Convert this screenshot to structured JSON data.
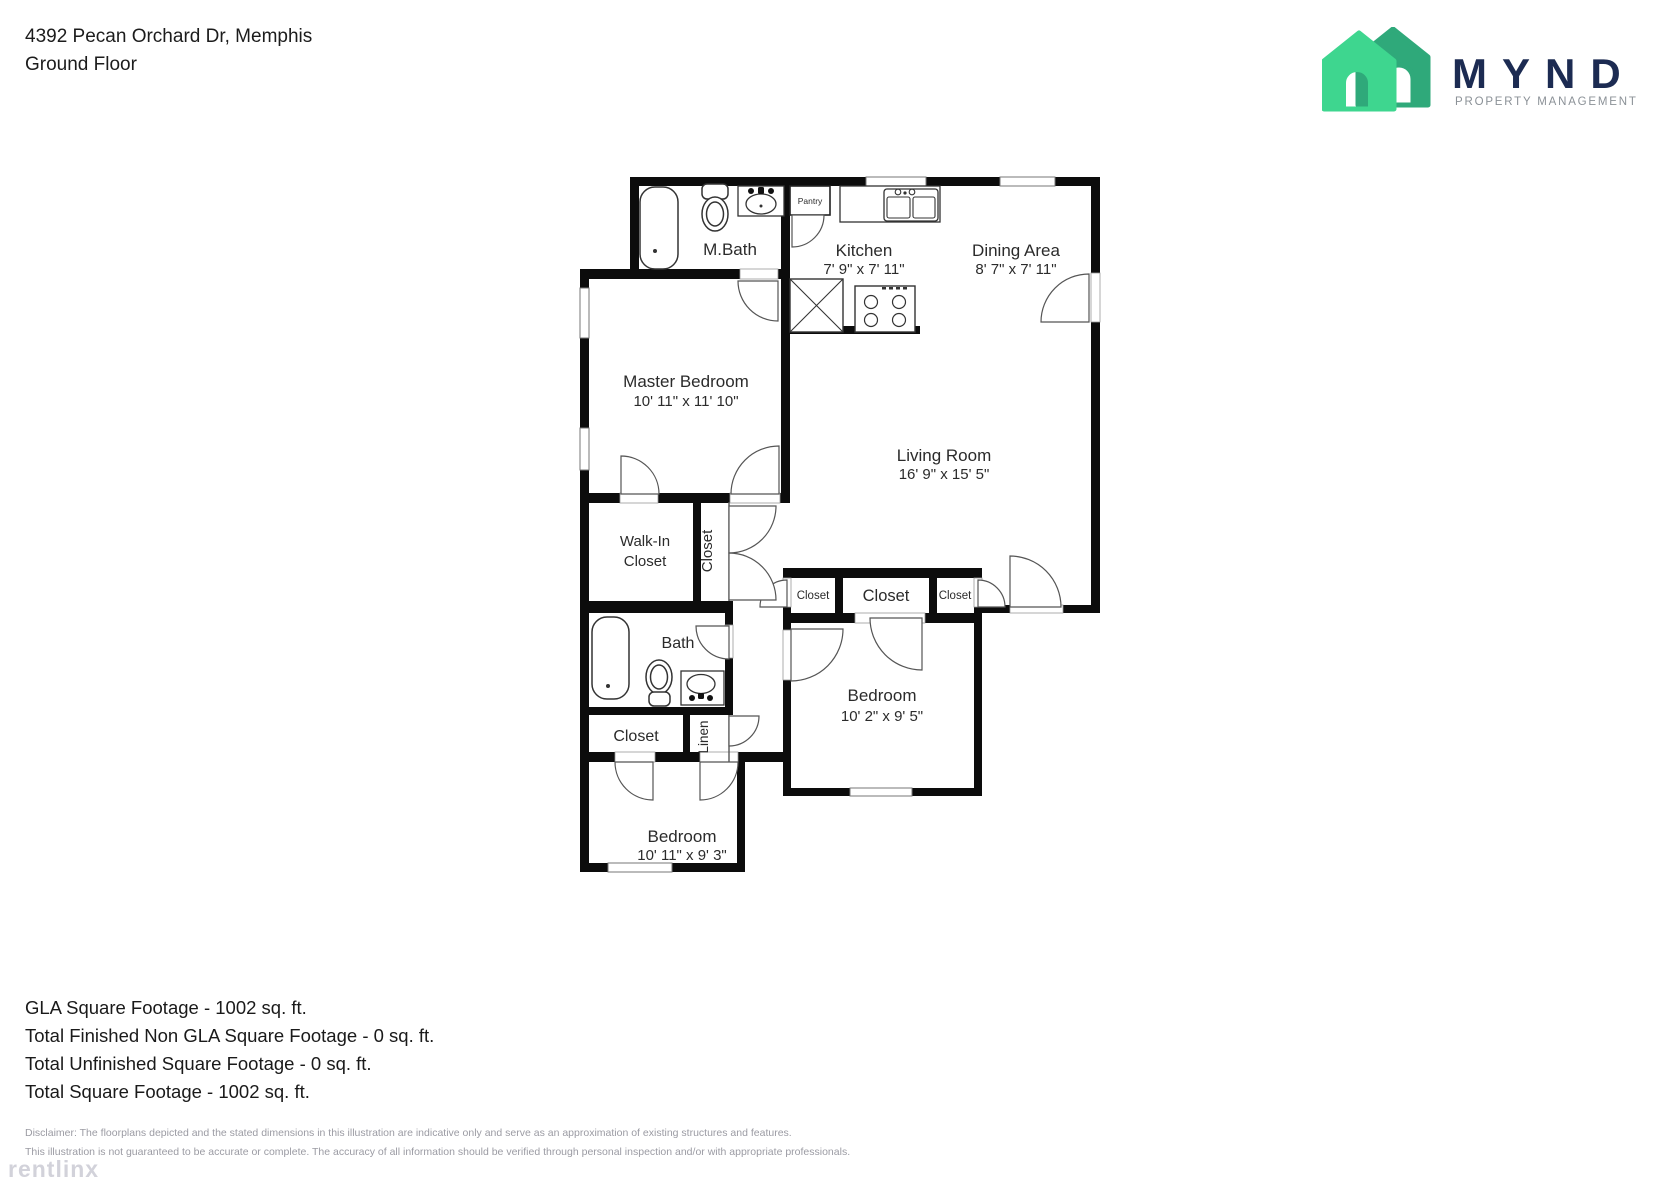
{
  "header": {
    "address": "4392 Pecan Orchard Dr, Memphis",
    "floor": "Ground Floor"
  },
  "logo": {
    "brand": "MYND",
    "tagline": "PROPERTY MANAGEMENT"
  },
  "colors": {
    "logo_green_front": "#3ED68F",
    "logo_green_back": "#2FA97A",
    "logo_navy": "#1C2B52",
    "tagline_gray": "#8B9197",
    "wall_black": "#0C0C0C"
  },
  "plan": {
    "labels": {
      "mbath": "M.Bath",
      "pantry": "Pantry",
      "kitchen_name": "Kitchen",
      "kitchen_dims": "7' 9\" x 7' 11\"",
      "dining_name": "Dining Area",
      "dining_dims": "8' 7\" x 7' 11\"",
      "master_name": "Master Bedroom",
      "master_dims": "10' 11\" x 11' 10\"",
      "living_name": "Living Room",
      "living_dims": "16' 9\" x 15' 5\"",
      "walkin_1": "Walk-In",
      "walkin_2": "Closet",
      "closet_vertical": "Closet",
      "bath": "Bath",
      "closet_left": "Closet",
      "closet_middle": "Closet",
      "closet_right": "Closet",
      "bedroom2_name": "Bedroom",
      "bedroom2_dims": "10' 2\" x 9' 5\"",
      "closet_hall": "Closet",
      "linen": "Linen",
      "bedroom3_name": "Bedroom",
      "bedroom3_dims": "10' 11\" x 9' 3\""
    }
  },
  "summary": {
    "gla": "GLA Square Footage - 1002 sq. ft.",
    "non_gla": "Total Finished Non GLA Square Footage - 0 sq. ft.",
    "unfinished": "Total Unfinished Square Footage - 0 sq. ft.",
    "total": "Total Square Footage - 1002 sq. ft."
  },
  "disclaimer": {
    "line1": "Disclaimer: The floorplans depicted and the stated dimensions in this illustration are indicative only and serve as an approximation of existing structures and features.",
    "line2": "This illustration is not guaranteed to be accurate or complete. The accuracy of all information should be verified through personal inspection and/or with appropriate professionals."
  },
  "watermark": "rentlinx"
}
